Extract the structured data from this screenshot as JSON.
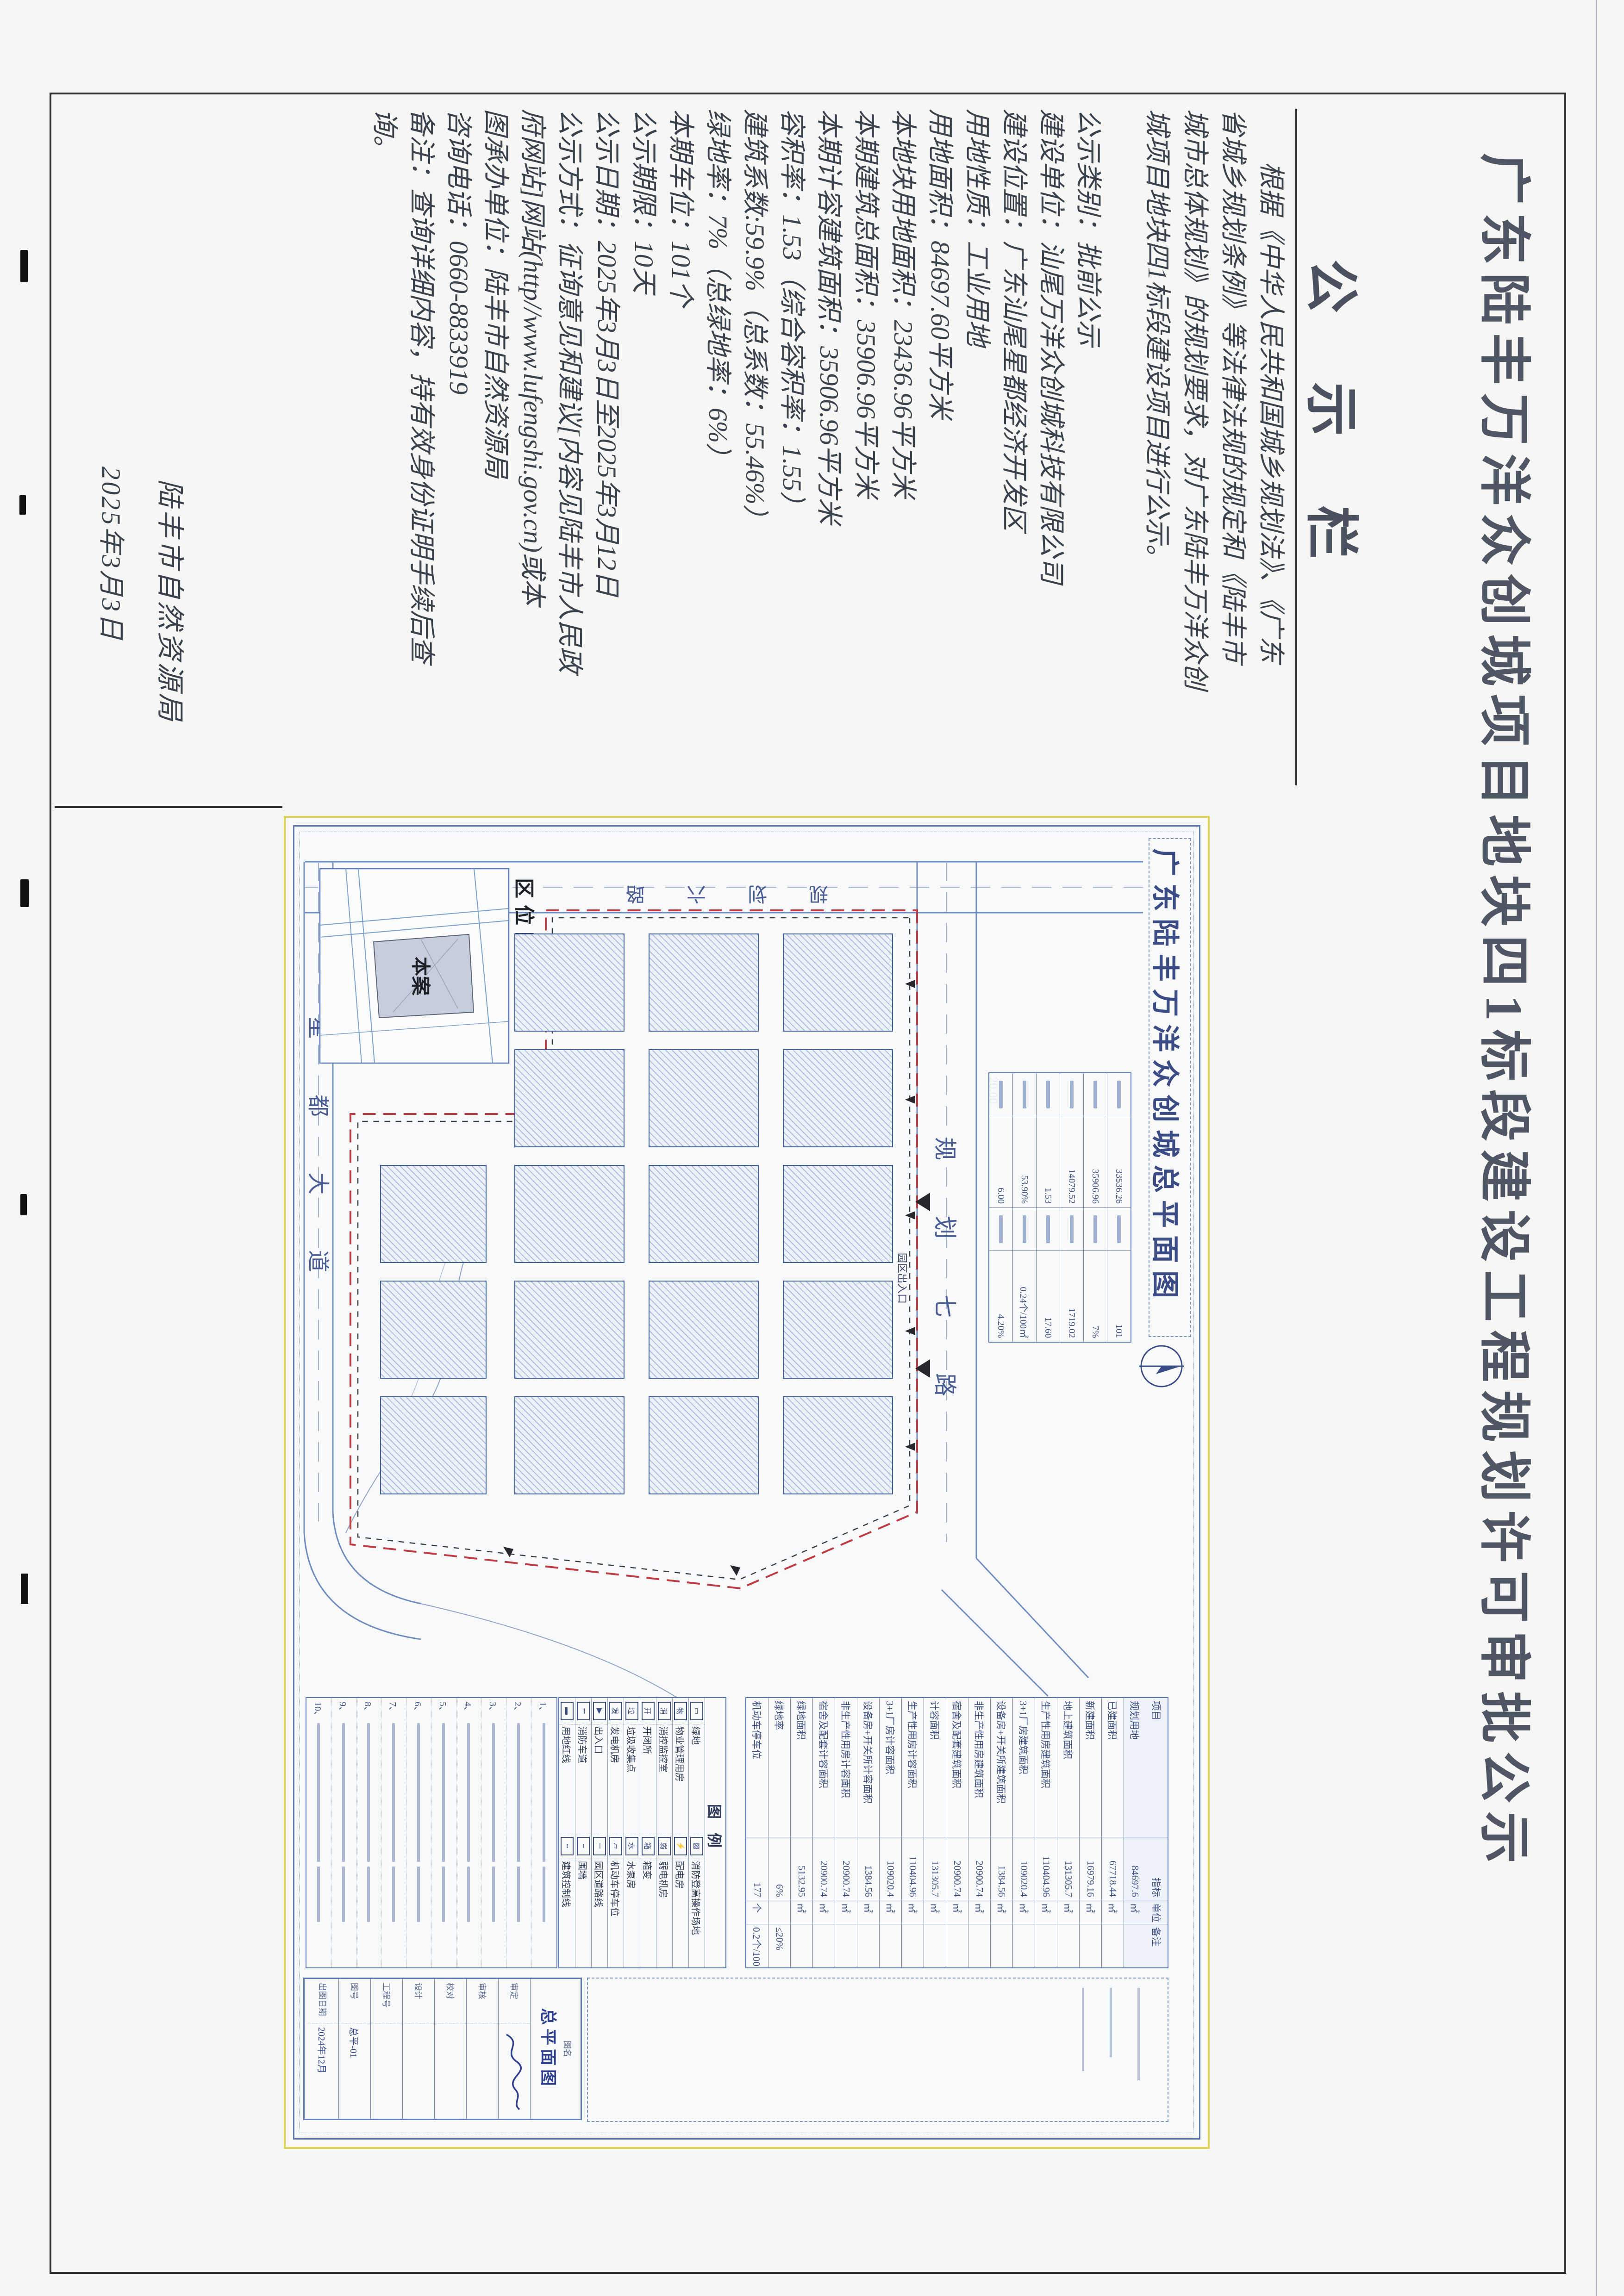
{
  "notice": {
    "title": "广东陆丰万洋众创城项目地块四1标段建设工程规划许可审批公示",
    "board_header": "公示栏",
    "paragraph_lines": [
      "　　根据《中华人民共和国城乡规划法》、《广东",
      "省城乡规划条例》等法律法规的规定和《陆丰市",
      "城市总体规划》的规划要求，对广东陆丰万洋众创",
      "城项目地块四1标段建设项目进行公示。"
    ],
    "item_lines": [
      "公示类别：批前公示",
      "建设单位：汕尾万洋众创城科技有限公司",
      "建设位置：广东汕尾星都经济开发区",
      "用地性质：工业用地",
      "用地面积：84697.60平方米",
      "本地块用地面积：23436.96平方米",
      "本期建筑总面积：35906.96平方米",
      "本期计容建筑面积：35906.96平方米",
      "容积率：1.53（综合容积率：1.55）",
      "建筑系数:59.9%（总系数：55.46%）",
      "绿地率：7%（总绿地率：6%）",
      "本期车位：101个",
      "公示期限：10天",
      "公示日期：2025年3月3日至2025年3月12日",
      "公示方式：征询意见和建议[内容见陆丰市人民政",
      "府网站]网站(http//www.lufengshi.gov.cn)或本",
      "图承办单位：陆丰市自然资源局",
      "咨询电话：0660-8833919",
      "备注：查询详细内容，持有效身份证明手续后查",
      "询。"
    ],
    "signature": "陆丰市自然资源局",
    "date": "2025年3月3日"
  },
  "drawing": {
    "title": "广东陆丰万洋众创城总平面图",
    "roads": {
      "north": "规划七路",
      "west": "规划六路",
      "south": "星都大道"
    },
    "road_width_dim": "20.00",
    "entrance_label": "园区出入口",
    "inset": {
      "label": "区位图",
      "site_label": "本案"
    },
    "plan_table_pairs": [
      {
        "a": "33536.26",
        "b": "101"
      },
      {
        "a": "35906.96",
        "b": "7%"
      },
      {
        "a": "14079.52",
        "b": "1719.02"
      },
      {
        "a": "1.53",
        "b": "17.60"
      },
      {
        "a": "53.90%",
        "b": "0.24个/100㎡"
      },
      {
        "a": "6.00",
        "b": "4.20%"
      }
    ],
    "indicator_table": {
      "header": {
        "item": "项目",
        "value": "指标",
        "unit": "单位",
        "note": "备注"
      },
      "rows": [
        {
          "item": "规划用地",
          "value": "84697.6",
          "unit": "㎡",
          "note": ""
        },
        {
          "item": "已建面积",
          "value": "67718.44",
          "unit": "㎡",
          "note": ""
        },
        {
          "item": "新建面积",
          "value": "16979.16",
          "unit": "㎡",
          "note": ""
        },
        {
          "item": "地上建筑面积",
          "value": "131305.7",
          "unit": "㎡",
          "note": ""
        },
        {
          "item": "生产性用房建筑面积",
          "value": "110404.96",
          "unit": "㎡",
          "note": ""
        },
        {
          "item": "3+1厂房建筑面积",
          "value": "109020.4",
          "unit": "㎡",
          "note": ""
        },
        {
          "item": "设备房+开关所建筑面积",
          "value": "1384.56",
          "unit": "㎡",
          "note": ""
        },
        {
          "item": "非生产性用房建筑面积",
          "value": "20900.74",
          "unit": "㎡",
          "note": ""
        },
        {
          "item": "宿舍及配套建筑面积",
          "value": "20900.74",
          "unit": "㎡",
          "note": ""
        },
        {
          "item": "计容面积",
          "value": "131305.7",
          "unit": "㎡",
          "note": ""
        },
        {
          "item": "生产性用房计容面积",
          "value": "110404.96",
          "unit": "㎡",
          "note": ""
        },
        {
          "item": "3+1厂房计容面积",
          "value": "109020.4",
          "unit": "㎡",
          "note": ""
        },
        {
          "item": "设备房+开关所计容面积",
          "value": "1384.56",
          "unit": "㎡",
          "note": ""
        },
        {
          "item": "非生产性用房计容面积",
          "value": "20900.74",
          "unit": "㎡",
          "note": ""
        },
        {
          "item": "宿舍及配套计容面积",
          "value": "20900.74",
          "unit": "㎡",
          "note": ""
        },
        {
          "item": "绿地面积",
          "value": "5132.95",
          "unit": "㎡",
          "note": ""
        },
        {
          "item": "绿地率",
          "value": "6%",
          "unit": "",
          "note": "≤20%"
        },
        {
          "item": "机动车停车位",
          "value": "177",
          "unit": "个",
          "note": "0.2个/100㎡"
        }
      ]
    },
    "legend": {
      "header": "图例",
      "rows": [
        {
          "s1": "▭",
          "l1": "绿地",
          "s2": "▨",
          "l2": "消防登高操作场地"
        },
        {
          "s1": "物",
          "l1": "物业管理用房",
          "s2": "⚡",
          "l2": "配电房"
        },
        {
          "s1": "消",
          "l1": "消控监控室",
          "s2": "弱",
          "l2": "弱电机房"
        },
        {
          "s1": "开",
          "l1": "开闭所",
          "s2": "箱",
          "l2": "箱变"
        },
        {
          "s1": "垃",
          "l1": "垃圾收集点",
          "s2": "水",
          "l2": "水泵房"
        },
        {
          "s1": "发",
          "l1": "发电机房",
          "s2": "▱",
          "l2": "机动车停车位"
        },
        {
          "s1": "▶",
          "l1": "出入口",
          "s2": "─",
          "l2": "园区道路线"
        },
        {
          "s1": "═",
          "l1": "消防车道",
          "s2": "╌",
          "l2": "围墙"
        },
        {
          "s1": "▬",
          "l1": "用地红线",
          "s2": "┅",
          "l2": "建筑控制线"
        }
      ]
    },
    "notes_numbers": [
      {
        "n": "1、"
      },
      {
        "n": "2、"
      },
      {
        "n": "3、"
      },
      {
        "n": "4、"
      },
      {
        "n": "5、"
      },
      {
        "n": "6、"
      },
      {
        "n": "7、"
      },
      {
        "n": "8、"
      },
      {
        "n": "9、"
      },
      {
        "n": "10、"
      }
    ],
    "titleblock": {
      "name_label": "图名",
      "drawing_name": "总平面图",
      "fields": [
        {
          "label": "审定",
          "value": ""
        },
        {
          "label": "审核",
          "value": ""
        },
        {
          "label": "校对",
          "value": ""
        },
        {
          "label": "设计",
          "value": ""
        },
        {
          "label": "工程号",
          "value": ""
        },
        {
          "label": "图号",
          "value": "总平-01"
        },
        {
          "label": "出图日期",
          "value": "2024年12月"
        }
      ]
    }
  }
}
